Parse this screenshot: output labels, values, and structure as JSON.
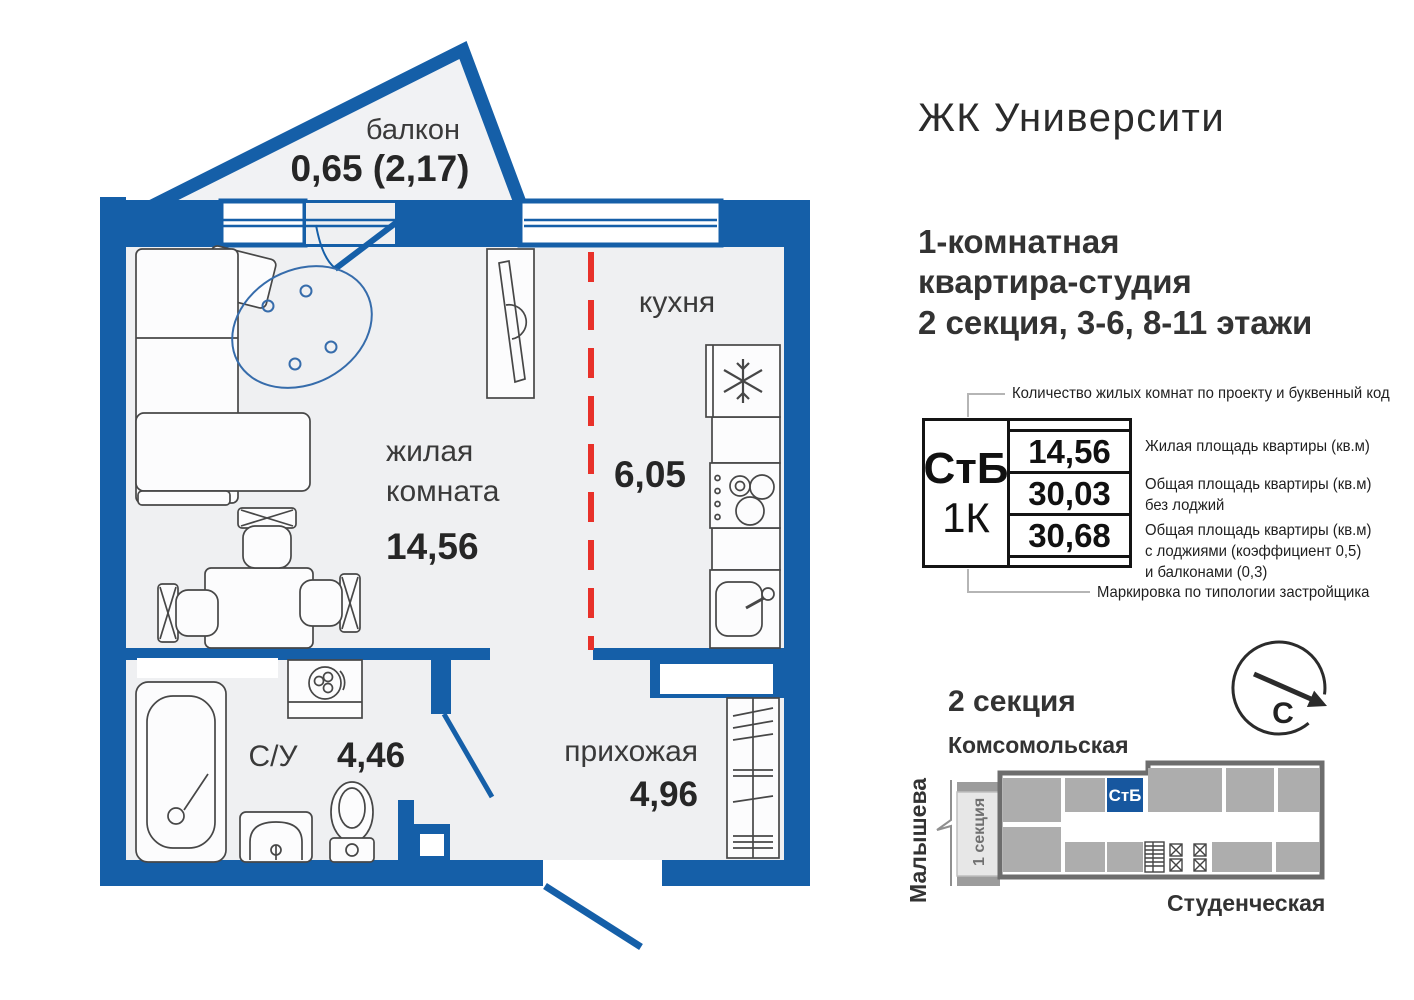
{
  "colors": {
    "wall_blue": "#155fa8",
    "dashed_red": "#e8312a",
    "marker_blue": "#17579f",
    "floor": "#eff0f2"
  },
  "header": {
    "title": "ЖК Университи",
    "subtitle_lines": [
      "1-комнатная",
      "квартира-студия",
      "2 секция, 3-6, 8-11 этажи"
    ]
  },
  "plan": {
    "balcony": {
      "label": "балкон",
      "area": "0,65 (2,17)"
    },
    "kitchen": {
      "label": "кухня",
      "area": "6,05"
    },
    "living": {
      "label_line1": "жилая",
      "label_line2": "комната",
      "area": "14,56"
    },
    "bathroom": {
      "label": "С/У",
      "area": "4,46"
    },
    "hallway": {
      "label": "прихожая",
      "area": "4,96"
    }
  },
  "spec_table": {
    "type_code": "СтБ",
    "room_code": "1К",
    "values": [
      "14,56",
      "30,03",
      "30,68"
    ],
    "top_note": "Количество жилых комнат по проекту и буквенный код",
    "bottom_note": "Маркировка по типологии застройщика",
    "value_notes": [
      [
        "Жилая площадь квартиры (кв.м)"
      ],
      [
        "Общая площадь квартиры (кв.м)",
        "без лоджий"
      ],
      [
        "Общая площадь квартиры (кв.м)",
        "с лоджиями (коэффициент 0,5)",
        "и балконами (0,3)"
      ]
    ]
  },
  "section_map": {
    "heading": "2 секция",
    "street_top": "Комсомольская",
    "street_left": "Малышева",
    "street_bottom": "Студенческая",
    "unit_marker": "СтБ",
    "adjacent_section": "1 секция",
    "compass_north": "С"
  }
}
